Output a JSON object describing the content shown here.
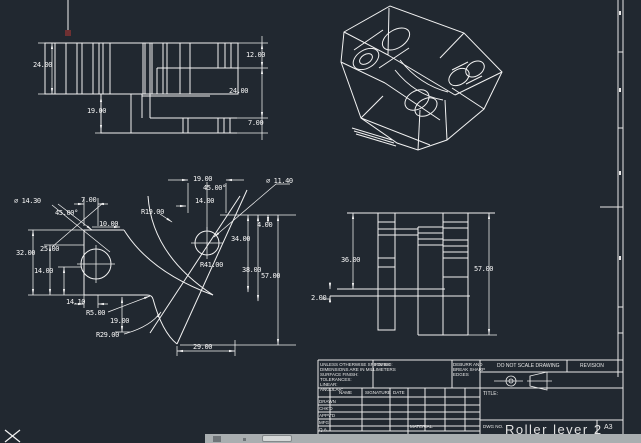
{
  "canvas": {
    "background": "#212830",
    "line_color": "#f2f2f2",
    "cursor_marker_color": "#6e3032"
  },
  "top_view": {
    "dims": {
      "left_height": "24.00",
      "lower_height": "19.00",
      "right_top": "12.00",
      "right_mid": "24.00",
      "right_bottom": "7.00"
    }
  },
  "front_view": {
    "dims": {
      "hole_left_dia": "⌀ 14.30",
      "chamfer_left": "45.00°",
      "top_left_width": "7.00",
      "top_small_width": "10.00",
      "radius_r19": "R19.00",
      "top_width_19": "19.00",
      "chamfer_top": "45.00°",
      "top_width_14": "14.00",
      "hole_right_dia": "⌀ 11.40",
      "right_4": "4.00",
      "right_34": "34.00",
      "left_25": "25.00",
      "left_32": "32.00",
      "left_14": "14.00",
      "radius_r41": "R41.00",
      "right_38": "38.00",
      "right_57": "57.00",
      "bottom_14": "14.10",
      "radius_r5": "R5.00",
      "bottom_19": "19.00",
      "radius_r29": "R29.00",
      "bottom_29": "29.00"
    }
  },
  "side_view": {
    "dims": {
      "height_36": "36.00",
      "height_57": "57.00",
      "offset_2": "2.00"
    }
  },
  "title_block": {
    "tolerance_note": "UNLESS OTHERWISE SPECIFIED:\nDIMENSIONS ARE IN MILLIMETERS\nSURFACE FINISH:\nTOLERANCES:\n   LINEAR:\n   ANGULAR:",
    "finish_label": "FINISH",
    "deburr_note": "DEBURR AND\nBREAK SHARP\nEDGES",
    "do_not_scale": "DO NOT SCALE DRAWING",
    "revision_label": "REVISION",
    "name_col": "NAME",
    "signature_col": "SIGNATURE",
    "date_col": "DATE",
    "row_drawn": "DRAWN",
    "row_chkd": "CHK'D",
    "row_appvd": "APPV'D",
    "row_mfg": "MFG",
    "row_qa": "Q.A",
    "material_label": "MATERIAL:",
    "title_label": "TITLE:",
    "dwg_label": "DWG NO.",
    "drawing_title": "Roller lever 2",
    "sheet_size": "A3"
  }
}
